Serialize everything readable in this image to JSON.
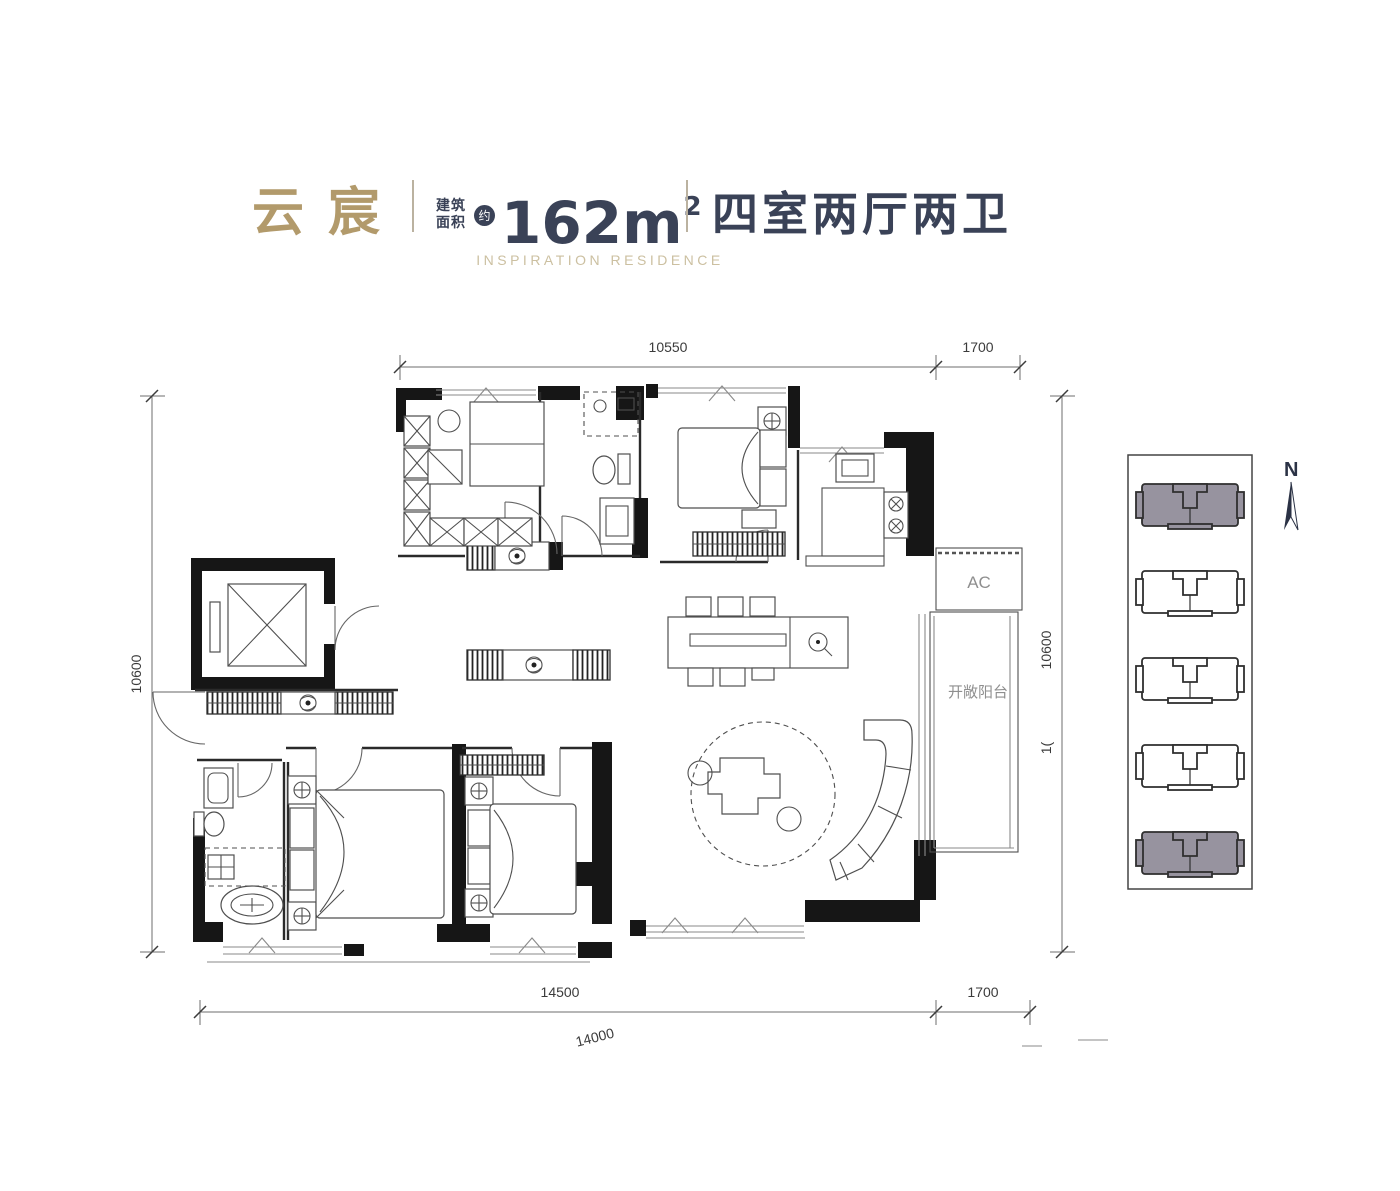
{
  "header": {
    "title": "云宸",
    "area_label_line1": "建筑",
    "area_label_line2": "面积",
    "area_approx_badge": "约",
    "area_value": "162m",
    "area_exponent": "2",
    "unit_type": "四室两厅两卫",
    "subtitle": "INSPIRATION RESIDENCE"
  },
  "plan": {
    "labels": {
      "ac_zone": "AC",
      "open_balcony": "开敞阳台"
    },
    "dimensions": {
      "top_main": "10550",
      "top_right": "1700",
      "left_side": "10600",
      "right_side": "10600",
      "right_side_partial": "1(",
      "bottom_main": "14500",
      "bottom_right": "1700",
      "bottom_note": "14000"
    }
  },
  "site_plan": {
    "compass_label": "N",
    "blocks": [
      {
        "id": "block-1",
        "highlighted": true
      },
      {
        "id": "block-2",
        "highlighted": false
      },
      {
        "id": "block-3",
        "highlighted": false
      },
      {
        "id": "block-4",
        "highlighted": false
      },
      {
        "id": "block-5",
        "highlighted": true
      }
    ]
  },
  "colors": {
    "brand_gold": "#B29A6B",
    "subtitle_gold": "#CCC0A1",
    "navy": "#3A4257",
    "site_block_fill": "#97939F",
    "wall_black": "#161616"
  }
}
